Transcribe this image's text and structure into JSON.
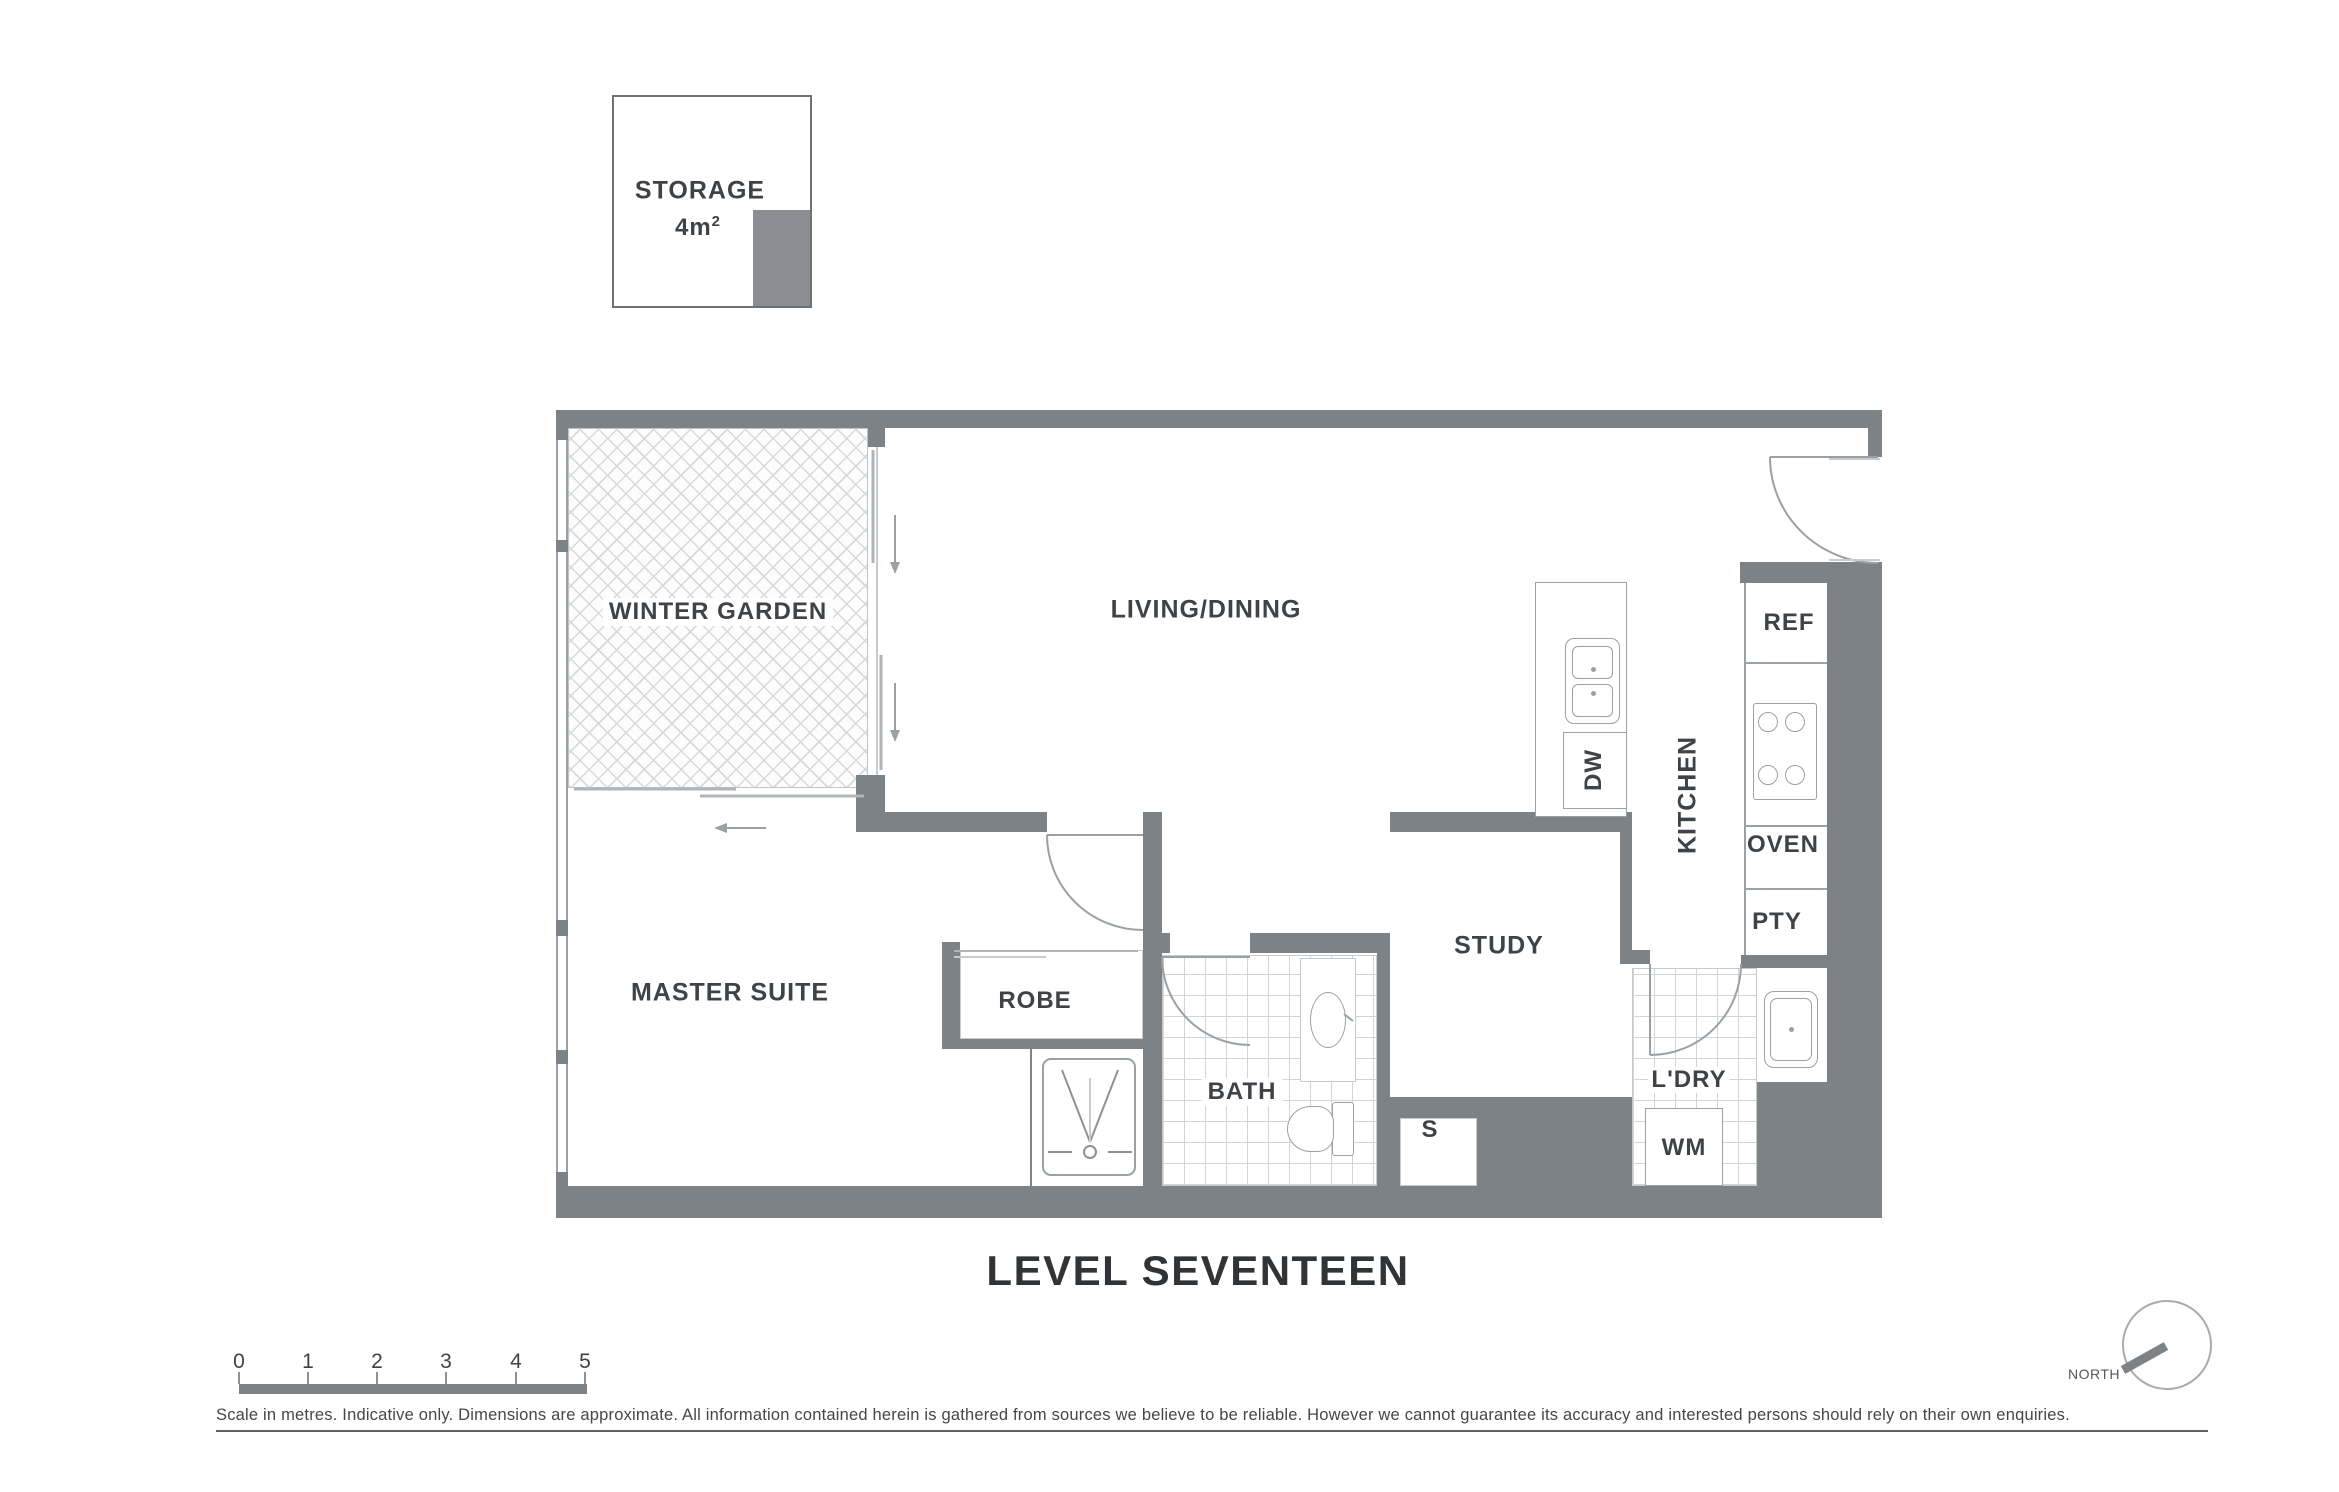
{
  "page": {
    "title": "LEVEL SEVENTEEN"
  },
  "storage_box": {
    "label": "STORAGE",
    "area_value": "4m",
    "area_sup": "2"
  },
  "rooms": {
    "winter_garden": "WINTER GARDEN",
    "living_dining": "LIVING/DINING",
    "master_suite": "MASTER SUITE",
    "robe": "ROBE",
    "bath": "BATH",
    "study": "STUDY",
    "kitchen": "KITCHEN",
    "laundry": "L'DRY",
    "storage_small": "S"
  },
  "fixtures": {
    "dishwasher": "DW",
    "refrigerator": "REF",
    "oven": "OVEN",
    "pantry": "PTY",
    "washing_machine": "WM"
  },
  "scale_bar": {
    "ticks": [
      "0",
      "1",
      "2",
      "3",
      "4",
      "5"
    ]
  },
  "compass": {
    "label": "NORTH"
  },
  "disclaimer": "Scale in metres. Indicative only. Dimensions are approximate. All information contained herein is gathered from sources we believe to be reliable. However we cannot guarantee its accuracy and interested persons should rely on their own enquiries.",
  "colors": {
    "wall": "#7d8286",
    "line": "#9aa0a4",
    "text": "#3f4347"
  }
}
